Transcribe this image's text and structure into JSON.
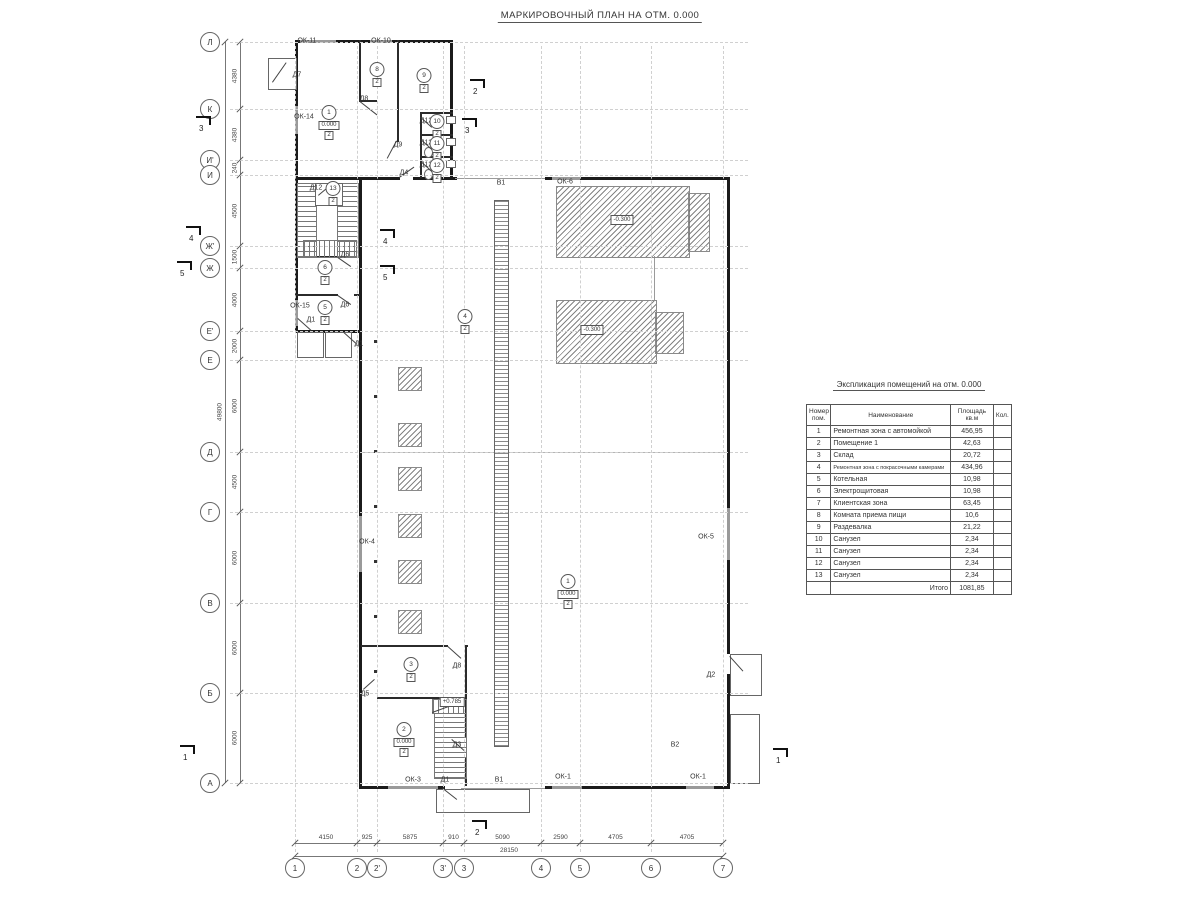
{
  "title": "МАРКИРОВОЧНЫЙ ПЛАН НА ОТМ. 0.000",
  "colors": {
    "wall": "#1b1b1b",
    "window": "#9a9a9a",
    "hatch": "#8a8a8a",
    "grid": "#d0d0d0",
    "dim": "#555555"
  },
  "axes": {
    "rows": [
      {
        "label": "Л",
        "y": 42
      },
      {
        "label": "К",
        "y": 109
      },
      {
        "label": "И'",
        "y": 160
      },
      {
        "label": "И",
        "y": 175
      },
      {
        "label": "Ж'",
        "y": 246
      },
      {
        "label": "Ж",
        "y": 268
      },
      {
        "label": "Е'",
        "y": 331
      },
      {
        "label": "Е",
        "y": 360
      },
      {
        "label": "Д",
        "y": 452
      },
      {
        "label": "Г",
        "y": 512
      },
      {
        "label": "В",
        "y": 603
      },
      {
        "label": "Б",
        "y": 693
      },
      {
        "label": "А",
        "y": 783
      }
    ],
    "cols": [
      {
        "label": "1",
        "x": 295
      },
      {
        "label": "2",
        "x": 357
      },
      {
        "label": "2'",
        "x": 377
      },
      {
        "label": "3'",
        "x": 443
      },
      {
        "label": "3",
        "x": 464
      },
      {
        "label": "4",
        "x": 541
      },
      {
        "label": "5",
        "x": 580
      },
      {
        "label": "6",
        "x": 651
      },
      {
        "label": "7",
        "x": 723
      }
    ],
    "row_dims": [
      {
        "v": "4380",
        "y1": 42,
        "y2": 109
      },
      {
        "v": "4380",
        "y1": 109,
        "y2": 160
      },
      {
        "v": "240",
        "y1": 160,
        "y2": 175
      },
      {
        "v": "4500",
        "y1": 175,
        "y2": 246
      },
      {
        "v": "1500",
        "y1": 246,
        "y2": 268
      },
      {
        "v": "4000",
        "y1": 268,
        "y2": 331
      },
      {
        "v": "2000",
        "y1": 331,
        "y2": 360
      },
      {
        "v": "6000",
        "y1": 360,
        "y2": 452
      },
      {
        "v": "4500",
        "y1": 452,
        "y2": 512
      },
      {
        "v": "6000",
        "y1": 512,
        "y2": 603
      },
      {
        "v": "6000",
        "y1": 603,
        "y2": 693
      },
      {
        "v": "6000",
        "y1": 693,
        "y2": 783
      }
    ],
    "row_total": "49800",
    "col_dims": [
      {
        "v": "4150",
        "x1": 295,
        "x2": 357
      },
      {
        "v": "925",
        "x1": 357,
        "x2": 377
      },
      {
        "v": "5875",
        "x1": 377,
        "x2": 443
      },
      {
        "v": "910",
        "x1": 443,
        "x2": 464
      },
      {
        "v": "5090",
        "x1": 464,
        "x2": 541
      },
      {
        "v": "2590",
        "x1": 541,
        "x2": 580
      },
      {
        "v": "4705",
        "x1": 580,
        "x2": 651
      },
      {
        "v": "4705",
        "x1": 651,
        "x2": 723
      }
    ],
    "col_total": "28150"
  },
  "plan": {
    "labels": [
      {
        "t": "ОК-11",
        "x": 307,
        "y": 41
      },
      {
        "t": "ОК-10",
        "x": 381,
        "y": 41
      },
      {
        "t": "ОК-14",
        "x": 304,
        "y": 117
      },
      {
        "t": "ОК-15",
        "x": 300,
        "y": 306
      },
      {
        "t": "ОК-6",
        "x": 565,
        "y": 182
      },
      {
        "t": "ОК-4",
        "x": 367,
        "y": 542
      },
      {
        "t": "ОК-5",
        "x": 706,
        "y": 537
      },
      {
        "t": "ОК-3",
        "x": 413,
        "y": 780
      },
      {
        "t": "ОК-1",
        "x": 563,
        "y": 777
      },
      {
        "t": "ОК-1",
        "x": 698,
        "y": 777
      },
      {
        "t": "Д7",
        "x": 297,
        "y": 75
      },
      {
        "t": "Д8",
        "x": 364,
        "y": 99
      },
      {
        "t": "Д9",
        "x": 398,
        "y": 145
      },
      {
        "t": "Д4",
        "x": 404,
        "y": 173
      },
      {
        "t": "Д12",
        "x": 426,
        "y": 121
      },
      {
        "t": "Д12",
        "x": 426,
        "y": 143
      },
      {
        "t": "Д12",
        "x": 426,
        "y": 165
      },
      {
        "t": "Д12",
        "x": 316,
        "y": 188
      },
      {
        "t": "Д6",
        "x": 345,
        "y": 255
      },
      {
        "t": "Д6",
        "x": 345,
        "y": 305
      },
      {
        "t": "Д1",
        "x": 311,
        "y": 320
      },
      {
        "t": "Д1",
        "x": 359,
        "y": 344
      },
      {
        "t": "Д5",
        "x": 365,
        "y": 694
      },
      {
        "t": "Д8",
        "x": 457,
        "y": 666
      },
      {
        "t": "Д3",
        "x": 457,
        "y": 745
      },
      {
        "t": "Д1",
        "x": 445,
        "y": 780
      },
      {
        "t": "Д2",
        "x": 711,
        "y": 675
      },
      {
        "t": "В1",
        "x": 501,
        "y": 183
      },
      {
        "t": "В1",
        "x": 499,
        "y": 780
      },
      {
        "t": "В2",
        "x": 675,
        "y": 745
      }
    ],
    "rooms": [
      {
        "num": "1",
        "elev": "0.000",
        "sub": "2",
        "x": 329,
        "y": 105
      },
      {
        "num": "8",
        "sub": "2",
        "x": 377,
        "y": 62
      },
      {
        "num": "9",
        "sub": "2",
        "x": 424,
        "y": 68
      },
      {
        "num": "10",
        "sub": "2",
        "x": 437,
        "y": 114
      },
      {
        "num": "11",
        "sub": "2",
        "x": 437,
        "y": 136
      },
      {
        "num": "12",
        "sub": "2",
        "x": 437,
        "y": 158
      },
      {
        "num": "13",
        "sub": "2",
        "x": 333,
        "y": 181
      },
      {
        "num": "6",
        "sub": "2",
        "x": 325,
        "y": 260
      },
      {
        "num": "5",
        "sub": "2",
        "x": 325,
        "y": 300
      },
      {
        "num": "4",
        "sub": "2",
        "x": 465,
        "y": 309
      },
      {
        "num": "1",
        "elev": "0.000",
        "sub": "2",
        "x": 568,
        "y": 574
      },
      {
        "num": "3",
        "sub": "2",
        "x": 411,
        "y": 657
      },
      {
        "num": "2",
        "elev": "0.000",
        "sub": "2",
        "x": 404,
        "y": 722
      }
    ],
    "elevations": [
      {
        "t": "-0.300",
        "x": 622,
        "y": 220
      },
      {
        "t": "-0.300",
        "x": 592,
        "y": 330
      },
      {
        "t": "+0.785",
        "x": 452,
        "y": 702
      }
    ],
    "sections": [
      {
        "n": "3",
        "x": 196,
        "y": 116
      },
      {
        "n": "3",
        "x": 462,
        "y": 118
      },
      {
        "n": "4",
        "x": 186,
        "y": 226
      },
      {
        "n": "4",
        "x": 380,
        "y": 229
      },
      {
        "n": "5",
        "x": 177,
        "y": 261
      },
      {
        "n": "5",
        "x": 380,
        "y": 265
      },
      {
        "n": "2",
        "x": 470,
        "y": 79
      },
      {
        "n": "2",
        "x": 472,
        "y": 820
      },
      {
        "n": "1",
        "x": 180,
        "y": 745
      },
      {
        "n": "1",
        "x": 773,
        "y": 748
      }
    ]
  },
  "table": {
    "title": "Экспликация помещений на отм. 0.000",
    "headers": [
      "Номер пом.",
      "Наименование",
      "Площадь кв.м",
      "Кол."
    ],
    "rows": [
      [
        "1",
        "Ремонтная зона с автомойкой",
        "456,95",
        ""
      ],
      [
        "2",
        "Помещение 1",
        "42,63",
        ""
      ],
      [
        "3",
        "Склад",
        "20,72",
        ""
      ],
      [
        "4",
        "Ремонтная зона с покрасочными камерами",
        "434,96",
        ""
      ],
      [
        "5",
        "Котельная",
        "10,98",
        ""
      ],
      [
        "6",
        "Электрощитовая",
        "10,98",
        ""
      ],
      [
        "7",
        "Клиентская зона",
        "63,45",
        ""
      ],
      [
        "8",
        "Комната приема пищи",
        "10,6",
        ""
      ],
      [
        "9",
        "Раздевалка",
        "21,22",
        ""
      ],
      [
        "10",
        "Санузел",
        "2,34",
        ""
      ],
      [
        "11",
        "Санузел",
        "2,34",
        ""
      ],
      [
        "12",
        "Санузел",
        "2,34",
        ""
      ],
      [
        "13",
        "Санузел",
        "2,34",
        ""
      ]
    ],
    "total_label": "Итого",
    "total_value": "1081,85"
  }
}
